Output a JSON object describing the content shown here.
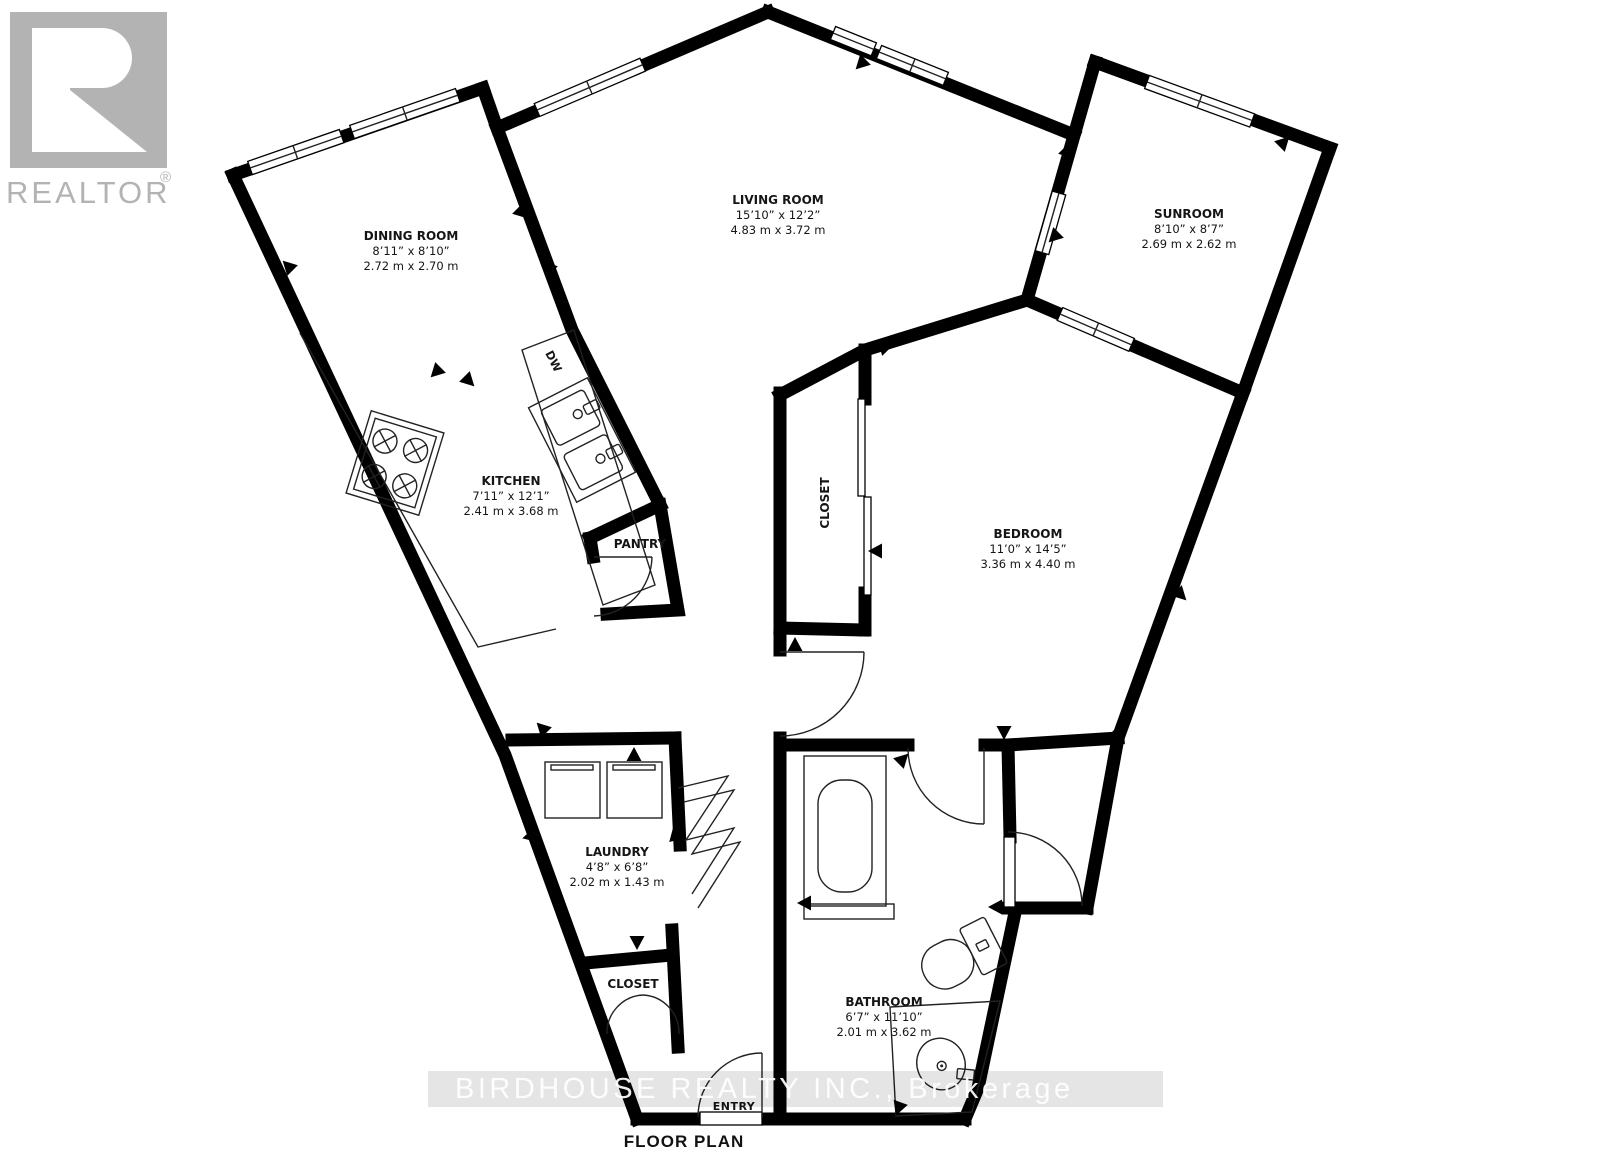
{
  "branding": {
    "logo_text": "REALTOR",
    "registered": "®",
    "watermark": "BIRDHOUSE REALTY INC., Brokerage"
  },
  "plan": {
    "title": "FLOOR PLAN",
    "rooms": {
      "dining": {
        "name": "DINING ROOM",
        "imperial": "8’11” x 8’10”",
        "metric": "2.72 m x 2.70 m"
      },
      "living": {
        "name": "LIVING ROOM",
        "imperial": "15’10” x 12’2”",
        "metric": "4.83 m x 3.72 m"
      },
      "sunroom": {
        "name": "SUNROOM",
        "imperial": "8’10” x 8’7”",
        "metric": "2.69 m x 2.62 m"
      },
      "kitchen": {
        "name": "KITCHEN",
        "imperial": "7’11” x 12’1”",
        "metric": "2.41 m x 3.68 m"
      },
      "bedroom": {
        "name": "BEDROOM",
        "imperial": "11’0” x 14’5”",
        "metric": "3.36 m x 4.40 m"
      },
      "laundry": {
        "name": "LAUNDRY",
        "imperial": "4’8” x 6’8”",
        "metric": "2.02 m x 1.43 m"
      },
      "bathroom": {
        "name": "BATHROOM",
        "imperial": "6’7” x 11’10”",
        "metric": "2.01 m x 3.62 m"
      }
    },
    "labels": {
      "closet_bedroom": "CLOSET",
      "closet_entry": "CLOSET",
      "pantry": "PANTRY",
      "entry": "ENTRY",
      "dishwasher": "DW"
    }
  }
}
